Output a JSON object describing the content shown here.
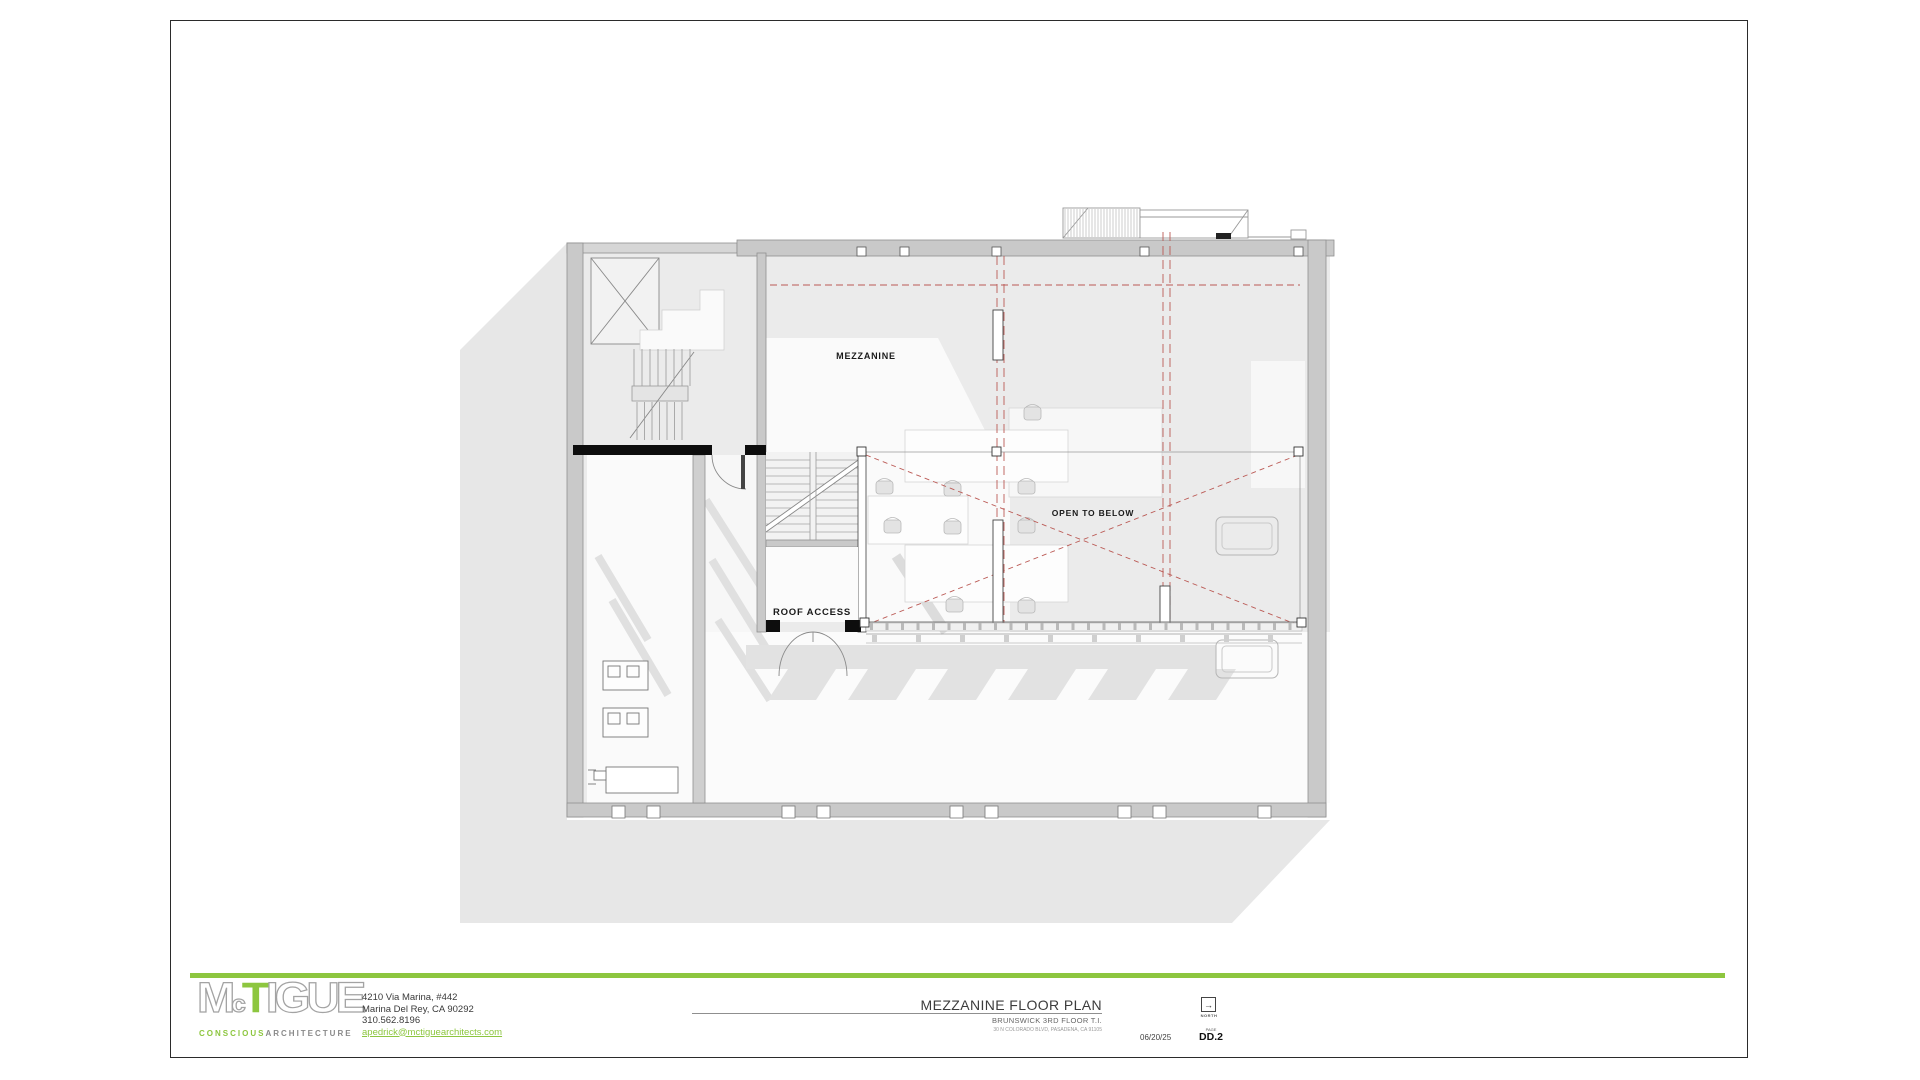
{
  "plan": {
    "labels": {
      "mezzanine": "MEZZANINE",
      "open_to_below": "OPEN TO BELOW",
      "roof_access": "ROOF ACCESS"
    }
  },
  "title_block": {
    "logo": {
      "letter_m": "M",
      "letter_c": "c",
      "letter_t": "T",
      "letters_rest": "IGUE",
      "tagline_word1": "CONSCIOUS",
      "tagline_word2": "ARCHITECTURE"
    },
    "contact": {
      "address_line1": "4210 Via Marina, #442",
      "address_line2": "Marina Del Rey, CA 90292",
      "phone": "310.562.8196",
      "email": "apedrick@mctiguearchitects.com"
    },
    "drawing": {
      "title": "MEZZANINE FLOOR PLAN",
      "project": "BRUNSWICK 3RD FLOOR T.I.",
      "project_address": "30 N COLORADO BLVD, PASADENA, CA 91105"
    },
    "meta": {
      "date": "06/20/25",
      "north_label": "NORTH",
      "north_glyph": "→",
      "sheet_label": "PAGE",
      "sheet_number": "DD.2"
    }
  },
  "colors": {
    "accent_green": "#8dc63f",
    "demo_red": "#bb5a55",
    "wall_gray": "#c9c9c9",
    "floor_gray": "#ebebeb",
    "shadow_gray": "#e7e7e7"
  }
}
